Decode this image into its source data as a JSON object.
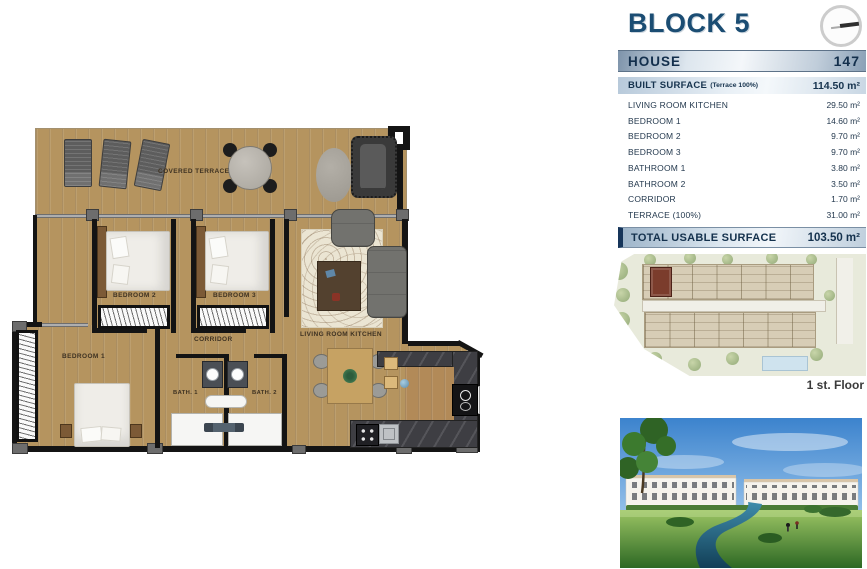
{
  "header": {
    "block_title": "BLOCK 5"
  },
  "house": {
    "label": "HOUSE",
    "number": "147"
  },
  "built_surface": {
    "label": "BUILT SURFACE",
    "note": "(Terrace 100%)",
    "value": "114.50 m²"
  },
  "rooms": [
    {
      "label": "LIVING ROOM KITCHEN",
      "value": "29.50 m²"
    },
    {
      "label": "BEDROOM 1",
      "value": "14.60 m²"
    },
    {
      "label": "BEDROOM 2",
      "value": "9.70 m²"
    },
    {
      "label": "BEDROOM 3",
      "value": "9.70 m²"
    },
    {
      "label": "BATHROOM 1",
      "value": "3.80 m²"
    },
    {
      "label": "BATHROOM 2",
      "value": "3.50 m²"
    },
    {
      "label": "CORRIDOR",
      "value": "1.70 m²"
    },
    {
      "label": "TERRACE (100%)",
      "value": "31.00 m²"
    }
  ],
  "total": {
    "label": "TOTAL USABLE SURFACE",
    "value": "103.50 m²"
  },
  "site_plan": {
    "floor_label": "1 st. Floor"
  },
  "plan": {
    "covered_terrace": "COVERED TERRACE",
    "bedroom_1": "BEDROOM 1",
    "bedroom_2": "BEDROOM 2",
    "bedroom_3": "BEDROOM 3",
    "corridor": "CORRIDOR",
    "bath_1": "BATH. 1",
    "bath_2": "BATH. 2",
    "living_room_kitchen": "LIVING ROOM KITCHEN"
  },
  "colors": {
    "accent_navy": "#1b4d73",
    "wood": "#b5945f",
    "highlighted_unit": "#7b3c2c",
    "pool": "#cfe3ee"
  }
}
